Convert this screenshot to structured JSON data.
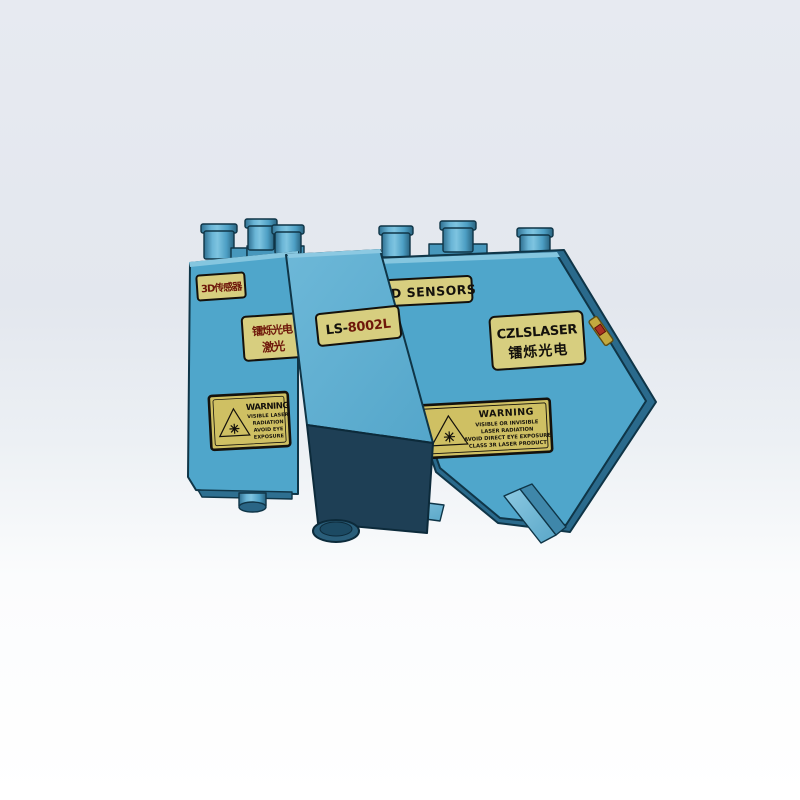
{
  "viewport": {
    "type": "cad-3d-render",
    "object": "dual 3D laser sensor modules"
  },
  "labels": {
    "left_small_label": "3D传感器",
    "left_module_label": {
      "line1": "镭烁光电",
      "line2": "激光"
    },
    "model_label": {
      "prefix": "LS-",
      "code": "8002L"
    },
    "sensors_label": "3D SENSORS",
    "brand_label": {
      "en": "CZLSLASER",
      "cn": "镭烁光电"
    },
    "left_warning_label": {
      "heading": "WARNING",
      "lines": [
        "VISIBLE LASER",
        "RADIATION",
        "AVOID EYE",
        "EXPOSURE"
      ]
    },
    "right_warning_label": {
      "heading": "WARNING",
      "lines": [
        "VISIBLE OR INVISIBLE",
        "LASER RADIATION",
        "AVOID DIRECT EYE EXPOSURE",
        "CLASS 3R LASER PRODUCT"
      ]
    }
  },
  "colors": {
    "body_blue": "#4FA6CB",
    "body_light": "#69B6D7",
    "body_highlight": "#85C6DF",
    "body_dark_face": "#1E3F55",
    "edge": "#0F3547",
    "decal_bg": "#D7CE7F",
    "warning_bg": "#CFC063",
    "decal_text_red": "#6E170A",
    "decal_text_black": "#14110C",
    "gold_connector": "#C2A93F",
    "indicator_red": "#A93122",
    "background_top": "#E7EAF1",
    "background_bottom": "#FFFFFF"
  }
}
